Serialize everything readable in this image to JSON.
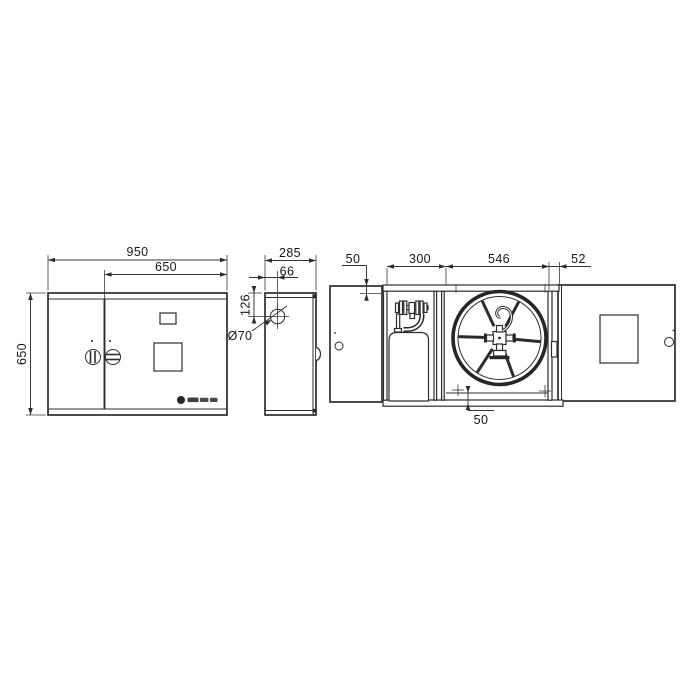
{
  "drawing": {
    "front_view": {
      "width_total": "950",
      "width_right_door": "650",
      "height": "650"
    },
    "side_view": {
      "depth": "285",
      "hole_offset_x": "66",
      "hole_offset_y": "126",
      "hole_diameter": "Ø70"
    },
    "open_view": {
      "top_offset": "50",
      "bay_left_width": "300",
      "bay_reel_width": "546",
      "right_offset": "52",
      "bottom_offset": "50"
    },
    "ink_color": "#2d2d2d",
    "background": "#ffffff"
  }
}
